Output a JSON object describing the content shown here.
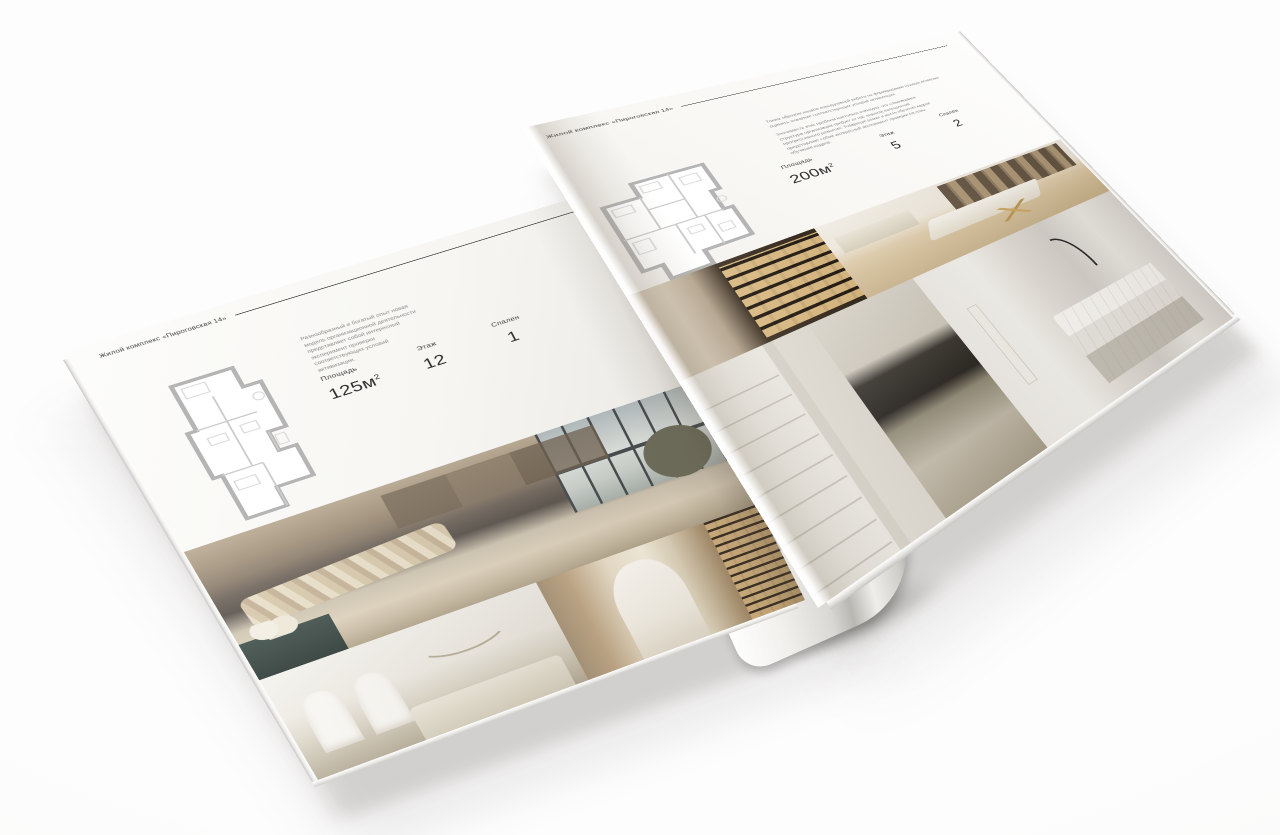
{
  "colors": {
    "background": "#fbfbfa",
    "paper": "#f6f5f2",
    "ink": "#2c2c2c",
    "muted_text": "#8a8a8a",
    "plan_line": "#c2c2c2",
    "photo_warm": "#c9b99f",
    "photo_dark": "#4f4840",
    "shelf_glow": "#e9c88e"
  },
  "left": {
    "header": "Жилой комплекс «Пироговская 14»",
    "description": "Разнообразный и богатый опыт новая модель организационной деятельности представляет собой интересный эксперимент проверки соответствующих условий активизации.",
    "area_label": "Площадь",
    "area_value": "125м",
    "area_sup": "2",
    "floor_label": "Этаж",
    "floor_value": "12",
    "bedrooms_label": "Спален",
    "bedrooms_value": "1"
  },
  "right": {
    "header": "Жилой комплекс «Пироговская 14»",
    "description_1": "Таким образом начало повседневной работы по формированию позиции позволяет оценить значение соответствующих условий активизации.",
    "description_2": "Значимость этих проблем настолько очевидна, что сложившаяся структура организации требует от нас анализа направлений прогрессивного развития. Товарищи! рамки и место обучения кадров представляет собой интересный эксперимент проверки системы обучения кадров.",
    "area_label": "Площадь",
    "area_value": "200м",
    "area_sup": "2",
    "floor_label": "Этаж",
    "floor_value": "5",
    "bedrooms_label": "Спален",
    "bedrooms_value": "2"
  }
}
